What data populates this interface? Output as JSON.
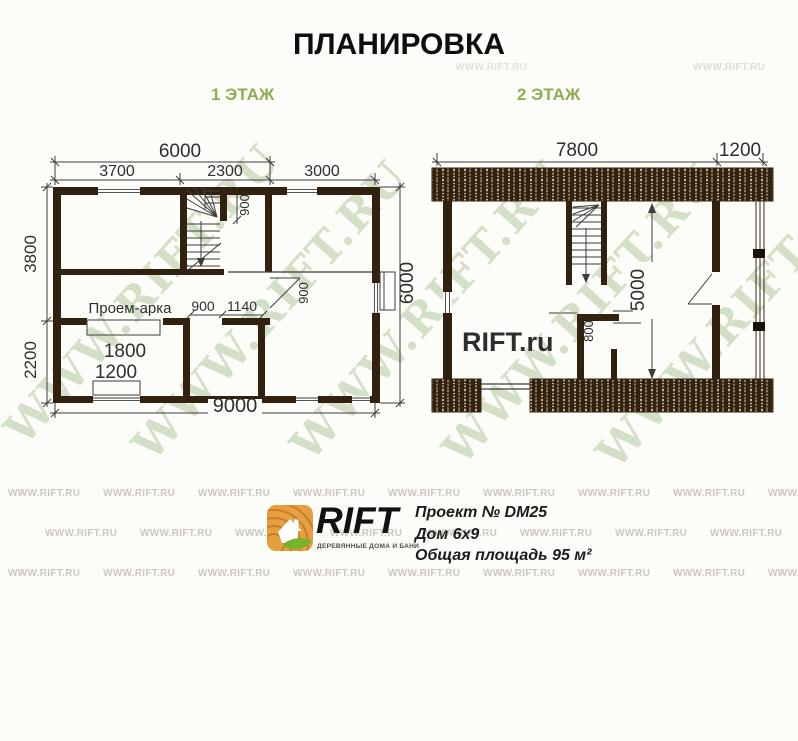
{
  "title": "ПЛАНИРОВКА",
  "floor1_label": "1 ЭТАЖ",
  "floor2_label": "2 ЭТАЖ",
  "plan1": {
    "dims": {
      "total_width_6m": "6000",
      "seg_a": "3700",
      "seg_b": "2300",
      "seg_c": "3000",
      "left_upper": "3800",
      "left_lower": "2200",
      "bottom_total": "9000",
      "right_height": "6000",
      "stair_width": "900",
      "hall_door": "900",
      "hall_offset": "1140",
      "arch_width": "1800",
      "window_width": "1200",
      "entry_door": "900"
    },
    "arch_label": "Проем-арка"
  },
  "plan2": {
    "dims": {
      "top_main": "7800",
      "top_balcony": "1200",
      "room_depth": "5000",
      "door": "800"
    },
    "site_label": "RIFT.ru"
  },
  "watermark": {
    "text": "WWW.RIFT.RU"
  },
  "footer": {
    "brand": "RIFT",
    "tagline": "ДЕРЕВЯННЫЕ ДОМА И БАНИ",
    "line1": "Проект № DM25",
    "line2": "Дом 6х9",
    "line3": "Общая площадь 95 м²"
  },
  "colors": {
    "wall": "#32210e",
    "accent_green": "#8fad52",
    "watermark_green": "#a8c48c",
    "logo_orange": "#e59f3e",
    "leaf_green": "#76b32a"
  }
}
